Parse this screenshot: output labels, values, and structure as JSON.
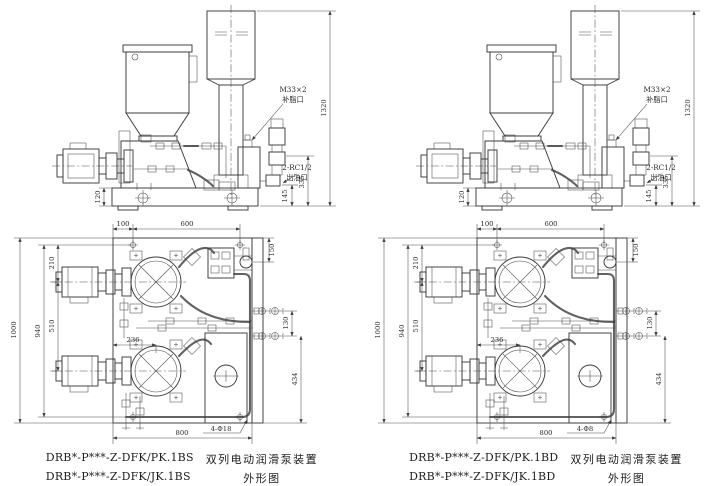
{
  "drawing": {
    "background": "#ffffff",
    "line_color": "#3b3b3b",
    "text_color": "#2b2b2b",
    "panels": [
      {
        "id": "left-unit",
        "elevation": {
          "label_fill_thread": "M33×2",
          "label_fill_port": "补脂口",
          "label_outlet_thread": "2-RC1/2",
          "label_outlet_port": "出油口",
          "dim_total_height": "1320",
          "dim_base_height": "120",
          "dim_outlet_elbow_height": "145",
          "dim_outlet_port_height": "335"
        },
        "plan": {
          "dim_edge_to_hole": "100",
          "dim_hole_span": "600",
          "dim_total_depth": "1000",
          "dim_hole_row_span": "940",
          "dim_top_to_motor1": "210",
          "dim_motor_spacing": "510",
          "dim_fill_pump_offset": "150",
          "dim_valve_row_spacing": "130",
          "dim_valve_to_bottom": "434",
          "dim_pump_axis_offset": "236",
          "dim_hole_col_span": "800",
          "label_mounting_holes": "4-Φ18"
        },
        "caption": {
          "model_line1": "DRB*-P***-Z-DFK/PK.1BS",
          "desc_line1": "双列电动润滑泵装置",
          "model_line2": "DRB*-P***-Z-DFK/JK.1BS",
          "desc_line2": "外形图"
        }
      },
      {
        "id": "right-unit",
        "elevation": {
          "label_fill_thread": "M33×2",
          "label_fill_port": "补脂口",
          "label_outlet_thread": "2-RC1/2",
          "label_outlet_port": "出油口",
          "dim_total_height": "1320",
          "dim_base_height": "120",
          "dim_outlet_elbow_height": "145",
          "dim_outlet_port_height": "335"
        },
        "plan": {
          "dim_edge_to_hole": "100",
          "dim_hole_span": "600",
          "dim_total_depth": "1000",
          "dim_hole_row_span": "940",
          "dim_top_to_motor1": "210",
          "dim_motor_spacing": "510",
          "dim_fill_pump_offset": "150",
          "dim_valve_row_spacing": "130",
          "dim_valve_to_bottom": "434",
          "dim_pump_axis_offset": "236",
          "dim_hole_col_span": "800",
          "label_mounting_holes": "4-Φ8"
        },
        "caption": {
          "model_line1": "DRB*-P***-Z-DFK/PK.1BD",
          "desc_line1": "双列电动润滑泵装置",
          "model_line2": "DRB*-P***-Z-DFK/JK.1BD",
          "desc_line2": "外形图"
        }
      }
    ]
  }
}
